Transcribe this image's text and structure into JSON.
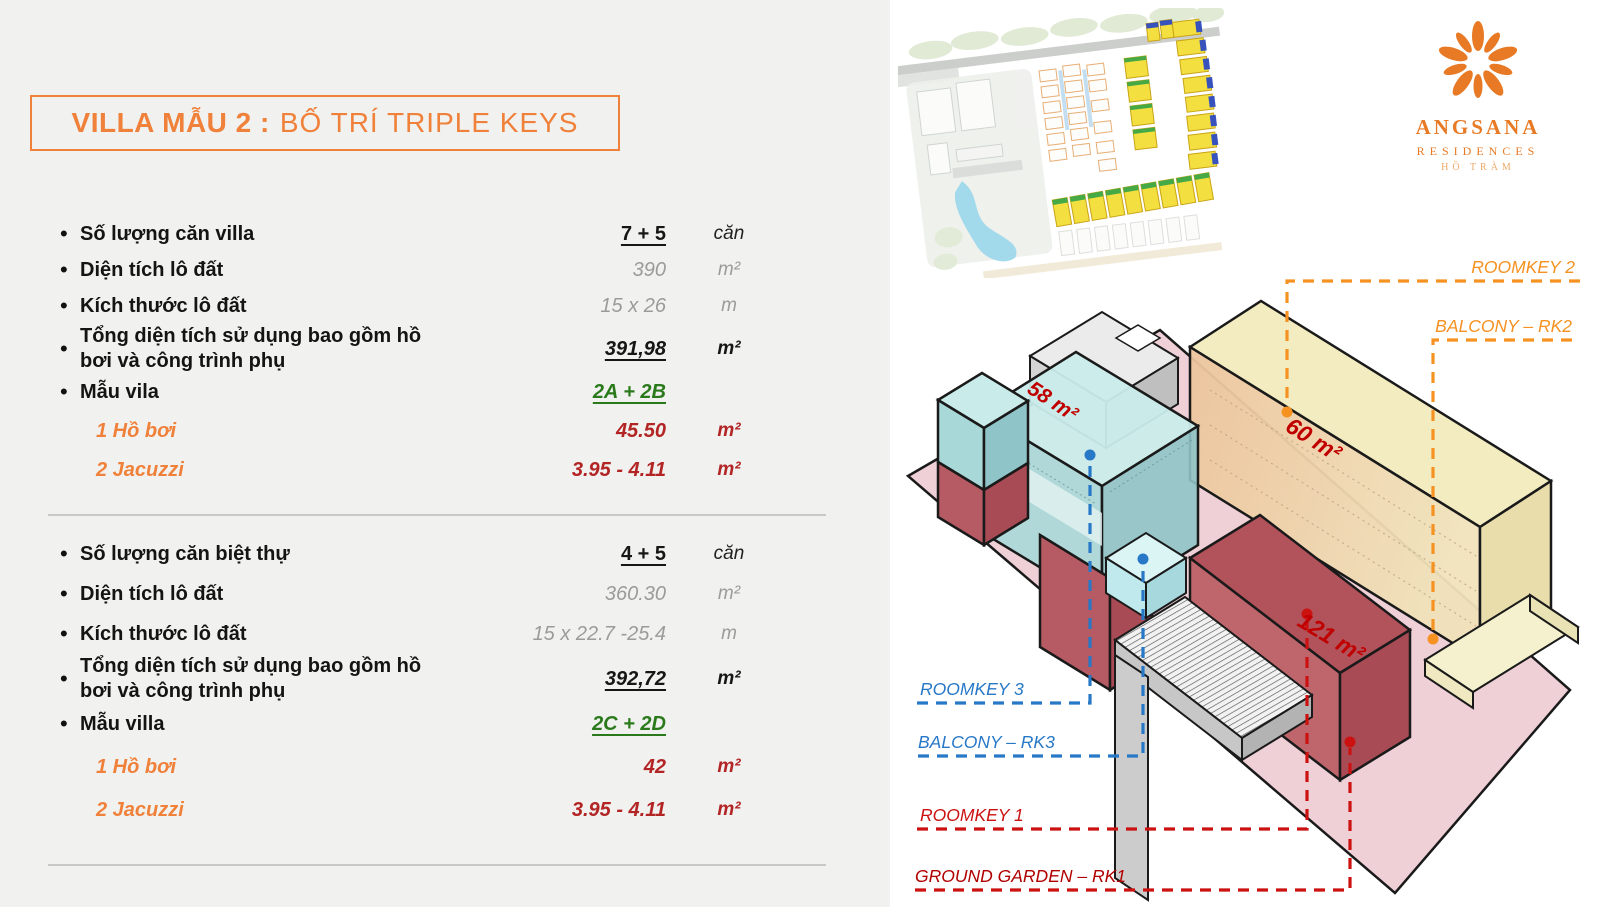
{
  "title": {
    "prefix": "VILLA MẪU 2 :",
    "rest": "BỐ TRÍ TRIPLE KEYS"
  },
  "sections": [
    {
      "rows": [
        {
          "bullet": true,
          "label": "Số lượng  căn villa",
          "value": "7 + 5",
          "unit": "căn",
          "style": "emph"
        },
        {
          "bullet": true,
          "label": "Diện tích lô đất",
          "value": "390",
          "unit": "m²",
          "style": "muted"
        },
        {
          "bullet": true,
          "label": "Kích thước lô đất",
          "value": "15 x 26",
          "unit": "m",
          "style": "muted"
        },
        {
          "bullet": true,
          "label": "Tổng diện tích sử dụng bao gồm hồ bơi và công trình phụ",
          "value": "391,98",
          "unit": "m²",
          "style": "emph-italic"
        },
        {
          "bullet": true,
          "label": "Mẫu vila",
          "value": "2A + 2B",
          "unit": "",
          "style": "model"
        },
        {
          "bullet": false,
          "label": "1 Hồ bơi",
          "value": "45.50",
          "unit": "m²",
          "style": "pool"
        },
        {
          "bullet": false,
          "label": "2 Jacuzzi",
          "value": "3.95 - 4.11",
          "unit": "m²",
          "style": "pool"
        }
      ]
    },
    {
      "rows": [
        {
          "bullet": true,
          "label": "Số lượng  căn biệt thự",
          "value": "4 + 5",
          "unit": "căn",
          "style": "emph"
        },
        {
          "bullet": true,
          "label": "Diện tích lô đất",
          "value": "360.30",
          "unit": "m²",
          "style": "muted"
        },
        {
          "bullet": true,
          "label": "Kích thước lô đất",
          "value": "15 x 22.7 -25.4",
          "unit": "m",
          "style": "muted"
        },
        {
          "bullet": true,
          "label": "Tổng diện tích sử dụng bao gồm hồ bơi và công trình phụ",
          "value": "392,72",
          "unit": "m²",
          "style": "emph-italic"
        },
        {
          "bullet": true,
          "label": "Mẫu villa",
          "value": "2C + 2D",
          "unit": "",
          "style": "model"
        },
        {
          "bullet": false,
          "label": "1 Hồ bơi",
          "value": "42",
          "unit": "m²",
          "style": "pool"
        },
        {
          "bullet": false,
          "label": "2 Jacuzzi",
          "value": "3.95 - 4.11",
          "unit": "m²",
          "style": "pool"
        }
      ]
    }
  ],
  "diagram": {
    "labels": {
      "roomkey2": "ROOMKEY 2",
      "balcony_rk2": "BALCONY – RK2",
      "roomkey3": "ROOMKEY 3",
      "balcony_rk3": "BALCONY – RK3",
      "roomkey1": "ROOMKEY 1",
      "ground_garden": "GROUND GARDEN – RK1"
    },
    "areas": {
      "rk3": "58 m²",
      "rk2": "60 m²",
      "rk1": "121 m²"
    },
    "colors": {
      "orange": "#f59222",
      "blue": "#2878c8",
      "red": "#cc1111",
      "darkred": "#b00000",
      "green": "#2a7a1c",
      "accent": "#f0813a"
    }
  },
  "logo": {
    "brand": "ANGSANA",
    "sub": "RESIDENCES",
    "location": "HỒ TRÀM"
  }
}
